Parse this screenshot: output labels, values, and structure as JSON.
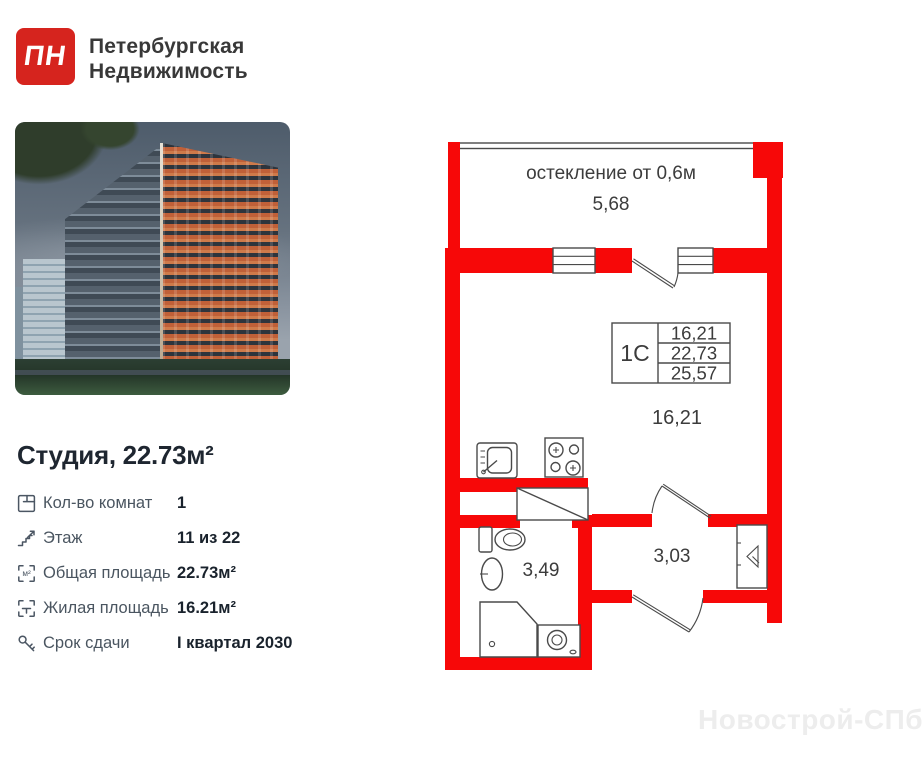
{
  "header": {
    "logo_text": "ПН",
    "brand_line1": "Петербургская",
    "brand_line2": "Недвижимость"
  },
  "listing": {
    "title": "Студия, 22.73м²",
    "specs": [
      {
        "label": "Кол-во комнат",
        "value": "1"
      },
      {
        "label": "Этаж",
        "value": "11 из 22"
      },
      {
        "label": "Общая площадь",
        "value": "22.73м²"
      },
      {
        "label": "Жилая площадь",
        "value": "16.21м²"
      },
      {
        "label": "Срок сдачи",
        "value": "I квартал 2030"
      }
    ]
  },
  "floor_plan": {
    "glazing_note": "остекление от 0,6м",
    "balcony_length": "5,68",
    "unit_label": "1С",
    "unit_table": {
      "living_area": "16,21",
      "total_area": "22,73",
      "total_with_balcony": "25,57"
    },
    "room_area": "16,21",
    "bathroom_area": "3,49",
    "hallway_area": "3,03",
    "icons": [
      "sink-icon",
      "stove-icon",
      "toilet-icon",
      "washbasin-icon",
      "shower-icon",
      "washing-machine-icon",
      "entrance-arrow-icon",
      "vent-shaft-icon"
    ],
    "colors": {
      "wall_red": "#f70808",
      "line_gray": "#4a4a4a"
    }
  },
  "watermark": "Новострой-СПб",
  "colors": {
    "logo_red": "#d6241e",
    "title_dark": "#1e2630",
    "label_gray": "#4a5560"
  }
}
